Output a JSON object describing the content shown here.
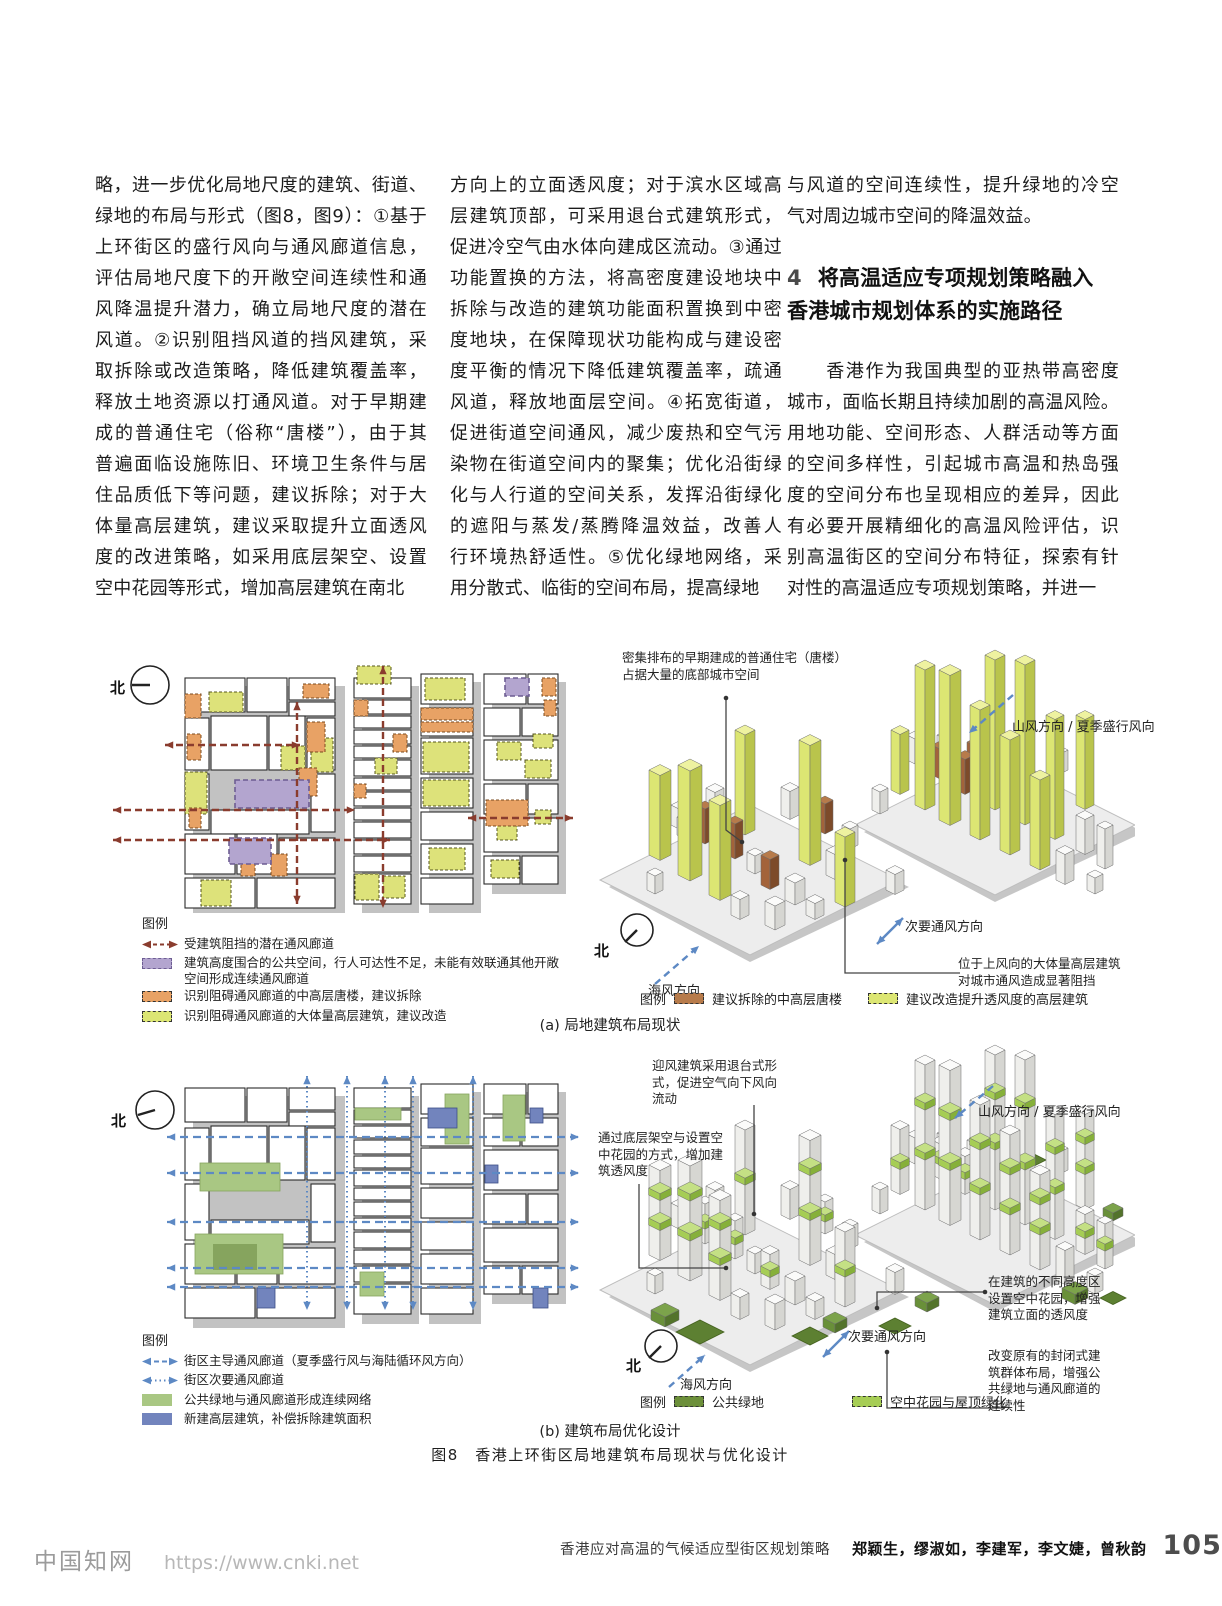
{
  "columns": {
    "col1": [
      "略，进一步优化局地尺度的建筑、街道、",
      "绿地的布局与形式（图8，图9）：①基于",
      "上环街区的盛行风向与通风廊道信息，",
      "评估局地尺度下的开敞空间连续性和通",
      "风降温提升潜力，确立局地尺度的潜在",
      "风道。②识别阻挡风道的挡风建筑，采",
      "取拆除或改造策略，降低建筑覆盖率，",
      "释放土地资源以打通风道。对于早期建",
      "成的普通住宅（俗称“唐楼”），由于其",
      "普遍面临设施陈旧、环境卫生条件与居",
      "住品质低下等问题，建议拆除；对于大",
      "体量高层建筑，建议采取提升立面透风",
      "度的改进策略，如采用底层架空、设置",
      "空中花园等形式，增加高层建筑在南北"
    ],
    "col2": [
      "方向上的立面透风度；对于滨水区域高",
      "层建筑顶部，可采用退台式建筑形式，",
      "促进冷空气由水体向建成区流动。③通过",
      "功能置换的方法，将高密度建设地块中",
      "拆除与改造的建筑功能面积置换到中密",
      "度地块，在保障现状功能构成与建设密",
      "度平衡的情况下降低建筑覆盖率，疏通",
      "风道，释放地面层空间。④拓宽街道，",
      "促进街道空间通风，减少废热和空气污",
      "染物在街道空间内的聚集；优化沿街绿",
      "化与人行道的空间关系，发挥沿街绿化",
      "的遮阳与蒸发/蒸腾降温效益，改善人",
      "行环境热舒适性。⑤优化绿地网络，采",
      "用分散式、临街的空间布局，提高绿地"
    ],
    "col3_para1": [
      "与风道的空间连续性，提升绿地的冷空",
      "气对周边城市空间的降温效益。"
    ],
    "heading_number": "4",
    "heading_line1": "将高温适应专项规划策略融入",
    "heading_line2": "香港城市规划体系的实施路径",
    "col3_para2": [
      "　　香港作为我国典型的亚热带高密度",
      "城市，面临长期且持续加剧的高温风险。",
      "用地功能、空间形态、人群活动等方面",
      "的空间多样性，引起城市高温和热岛强",
      "度的空间分布也呈现相应的差异，因此",
      "有必要开展精细化的高温风险评估，识",
      "别高温街区的空间分布特征，探索有针",
      "对性的高温适应专项规划策略，并进一"
    ]
  },
  "figure": {
    "north_label": "北",
    "panel_a": {
      "map_legend": {
        "title": "图例",
        "items": [
          {
            "label": "受建筑阻挡的潜在通风廊道"
          },
          {
            "label": "建筑高度围合的公共空间，行人可达性不足，未能有效联通其他开敞\n空间形成连续通风廊道"
          },
          {
            "label": "识别阻碍通风廊道的中高层唐楼，建议拆除"
          },
          {
            "label": "识别阻碍通风廊道的大体量高层建筑，建议改造"
          }
        ]
      },
      "annotations": {
        "tanglou": "密集排布的早期建成的普通住宅（唐楼）\n占据大量的底部城市空间",
        "mountain_wind": "山风方向 / 夏季盛行风向",
        "secondary_wind": "次要通风方向",
        "upwind_block": "位于上风向的大体量高层建筑\n对城市通风造成显著阻挡",
        "sea_wind": "海风方向"
      },
      "axon_legend": {
        "title": "图例",
        "items": [
          {
            "label": "建议拆除的中高层唐楼"
          },
          {
            "label": "建议改造提升透风度的高层建筑"
          }
        ]
      },
      "caption": "(a) 局地建筑布局现状"
    },
    "panel_b": {
      "map_legend": {
        "title": "图例",
        "items": [
          {
            "label": "街区主导通风廊道（夏季盛行风与海陆循环风方向）"
          },
          {
            "label": "街区次要通风廊道"
          },
          {
            "label": "公共绿地与通风廊道形成连续网络"
          },
          {
            "label": "新建高层建筑，补偿拆除建筑面积"
          }
        ]
      },
      "annotations": {
        "setback": "迎风建筑采用退台式形\n式，促进空气向下风向\n流动",
        "piloti": "通过底层架空与设置空\n中花园的方式，增加建\n筑透风度",
        "mountain_wind": "山风方向 / 夏季盛行风向",
        "sky_garden": "在建筑的不同高度区\n设置空中花园，增强\n建筑立面的透风度",
        "secondary_wind": "次要通风方向",
        "layout_change": "改变原有的封闭式建\n筑群体布局，增强公\n共绿地与通风廊道的\n连续性",
        "sea_wind": "海风方向"
      },
      "axon_legend": {
        "title": "图例",
        "items": [
          {
            "label": "公共绿地"
          },
          {
            "label": "空中花园与屋顶绿化"
          }
        ]
      },
      "caption": "(b) 建筑布局优化设计"
    },
    "caption": "图8　香港上环街区局地建筑布局现状与优化设计"
  },
  "footer": {
    "article_title": "香港应对高温的气候适应型街区规划策略",
    "authors": "郑颖生，缪淑如，李建军，李文婕，曾秋韵",
    "page_number": "105"
  },
  "watermark": {
    "name": "中国知网",
    "url": "https://www.cnki.net"
  },
  "colors": {
    "wind_arrow_blue": "#5d89c4",
    "blocked_corridor_red": "#8a3c2e",
    "tanglou_orange": "#e8a265",
    "highrise_yellow": "#dde27a",
    "public_space_purple": "#b3a5cf",
    "new_building_blue": "#7284bd",
    "public_green": "#6c8f3a",
    "sky_garden_green": "#a6cd55"
  }
}
